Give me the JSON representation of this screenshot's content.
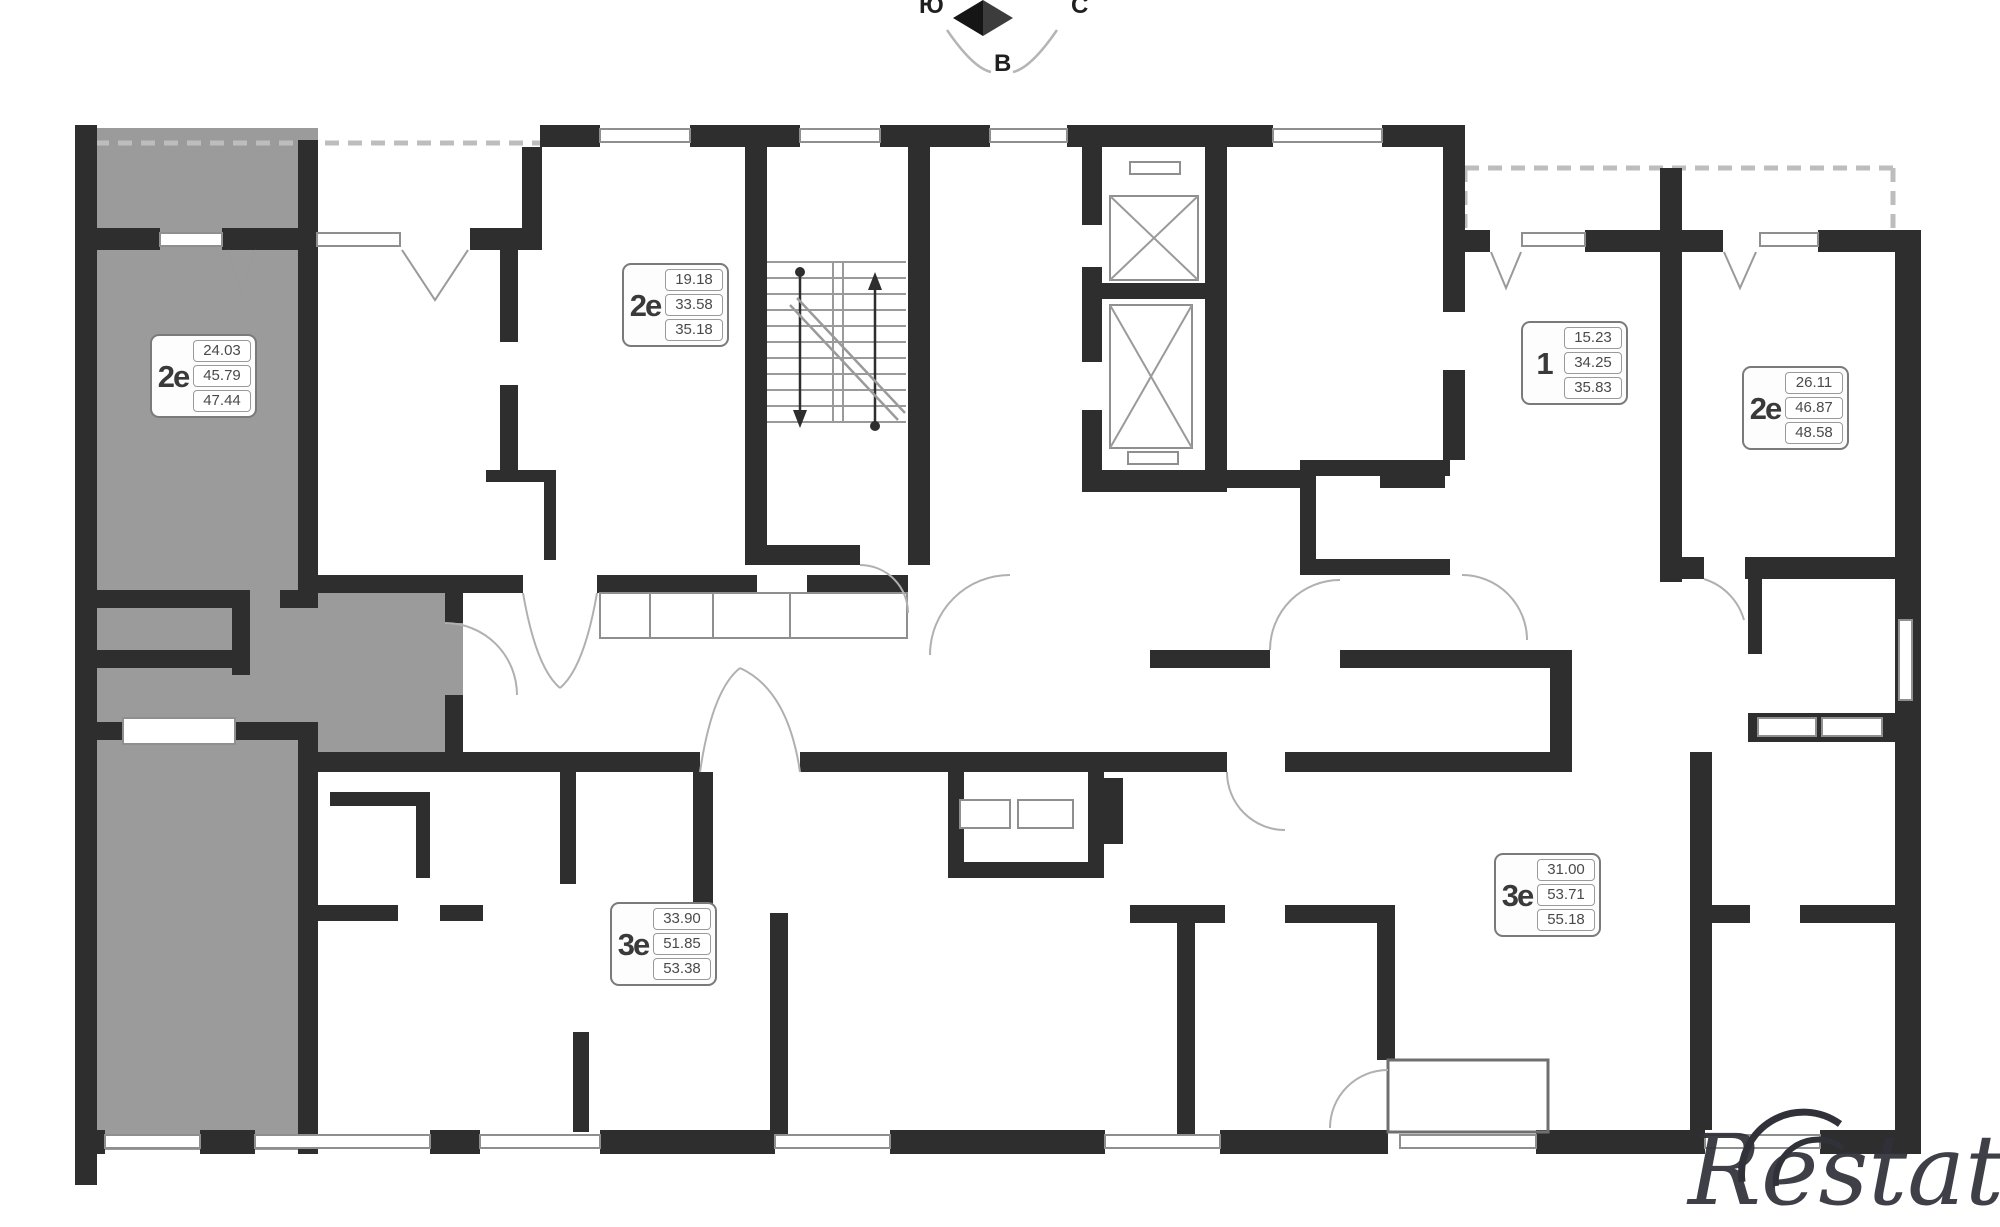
{
  "compass": {
    "south": "Ю",
    "north": "С",
    "east": "В"
  },
  "watermark": {
    "text": "Restate"
  },
  "apartments": [
    {
      "id": "left-highlighted",
      "type": "2е",
      "areas": [
        "24.03",
        "45.79",
        "47.44"
      ],
      "highlighted": true
    },
    {
      "id": "top-middle",
      "type": "2е",
      "areas": [
        "19.18",
        "33.58",
        "35.18"
      ],
      "highlighted": false
    },
    {
      "id": "top-right",
      "type": "1",
      "areas": [
        "15.23",
        "34.25",
        "35.83"
      ],
      "highlighted": false
    },
    {
      "id": "far-right",
      "type": "2е",
      "areas": [
        "26.11",
        "46.87",
        "48.58"
      ],
      "highlighted": false
    },
    {
      "id": "bottom-middle",
      "type": "3е",
      "areas": [
        "33.90",
        "51.85",
        "53.38"
      ],
      "highlighted": false
    },
    {
      "id": "bottom-right",
      "type": "3е",
      "areas": [
        "31.00",
        "53.71",
        "55.18"
      ],
      "highlighted": false
    }
  ],
  "colors": {
    "wall": "#2e2e2e",
    "highlight_fill": "#9b9b9b",
    "thin_line": "#8f8f8f",
    "watermark": "#31313a"
  }
}
